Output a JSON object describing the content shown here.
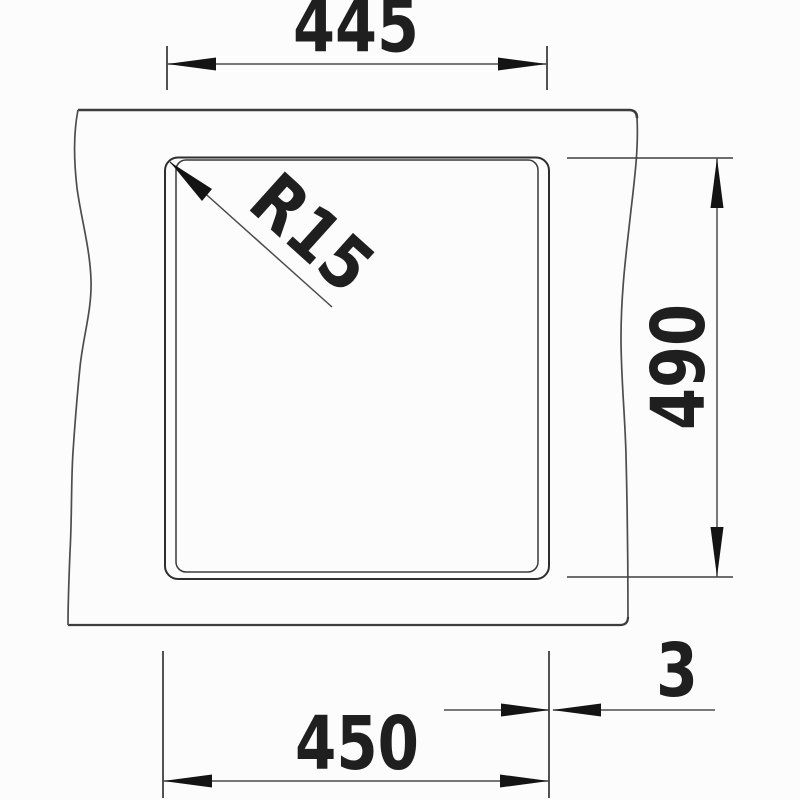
{
  "drawing": {
    "labels": {
      "top_width": "445",
      "corner_radius": "R15",
      "side_height": "490",
      "bottom_width": "450",
      "edge_gap": "3"
    },
    "colors": {
      "background": "#fcfcfc",
      "text": "#1f1f1f",
      "outline": "#3d3d3d",
      "break_edge": "#4d4d4d",
      "bowl_edge": "#2e2e2e",
      "dimension_line": "#4c4c4c",
      "extension_line": "#3f3f3f",
      "arrowhead": "#141414"
    }
  }
}
